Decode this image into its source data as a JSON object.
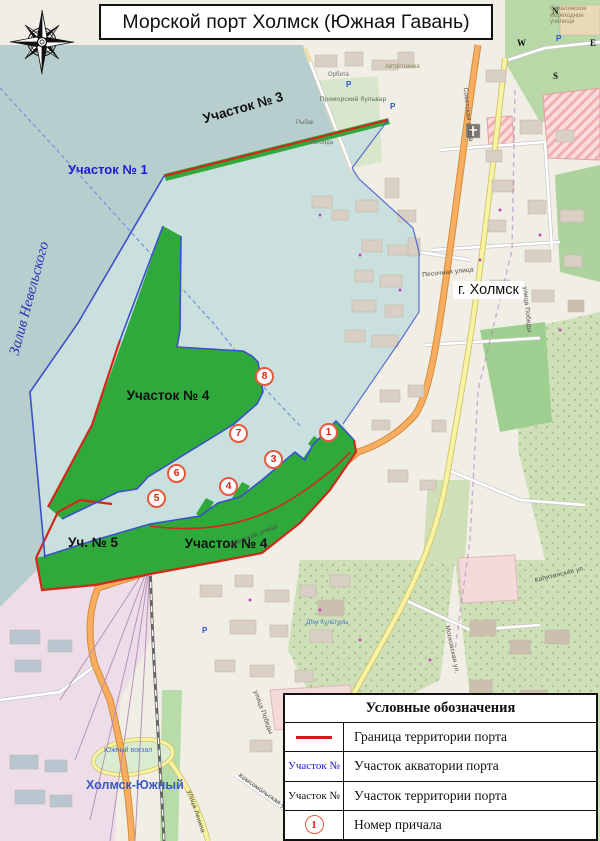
{
  "title": "Морской порт Холмск (Южная Гавань)",
  "compass": {
    "n": "N",
    "e": "E",
    "s": "S",
    "w": "W"
  },
  "water": {
    "bay_label": "Залив Невельского",
    "area1_label": "Участок № 1"
  },
  "port": {
    "area3_label": "Участок № 3",
    "area4_upper_label": "Участок № 4",
    "area4_lower_label": "Участок № 4",
    "area5_label": "Уч. № 5",
    "berth_numbers": [
      "1",
      "3",
      "4",
      "5",
      "6",
      "7",
      "8"
    ]
  },
  "city": {
    "name_label": "г. Холмск",
    "district_label": "Холмск-Южный",
    "station_label": "Южный вокзал",
    "streets": {
      "sovetskaya": "Советская улица",
      "pobedy": "улица Победы",
      "lenina": "улица Ленина",
      "komsomolskaya": "Комсомольская улица",
      "pesochnaya": "Песочная улица",
      "moskovskaya": "Московская ул.",
      "kapitanskaya": "Капитанская ул.",
      "primorsky": "Приморский бульвар"
    },
    "pois": {
      "dom_kultury": "Дом Культуры",
      "marine_college": "Сахалинское мореходное училище",
      "rybak": "Рыбак",
      "rotonda": "Ротонда",
      "avtostoyanka": "Автостоянка",
      "orbita": "Орбита",
      "parking_letter": "P"
    }
  },
  "legend": {
    "title": "Условные обозначения",
    "border_row_label": "Граница территории порта",
    "aqua_row_symbol": "Участок №",
    "aqua_row_label": "Участок акватории порта",
    "terr_row_symbol": "Участок №",
    "terr_row_label": "Участок территории порта",
    "berth_row_symbol": "1",
    "berth_row_label": "Номер причала"
  },
  "colors": {
    "sea": "#b6cfce",
    "aquatory": "#c9e0de",
    "territory_green": "#2fa83c",
    "border_red": "#d2281a",
    "border_blue": "#3c50c8",
    "berth_circle": "#e8593e"
  }
}
